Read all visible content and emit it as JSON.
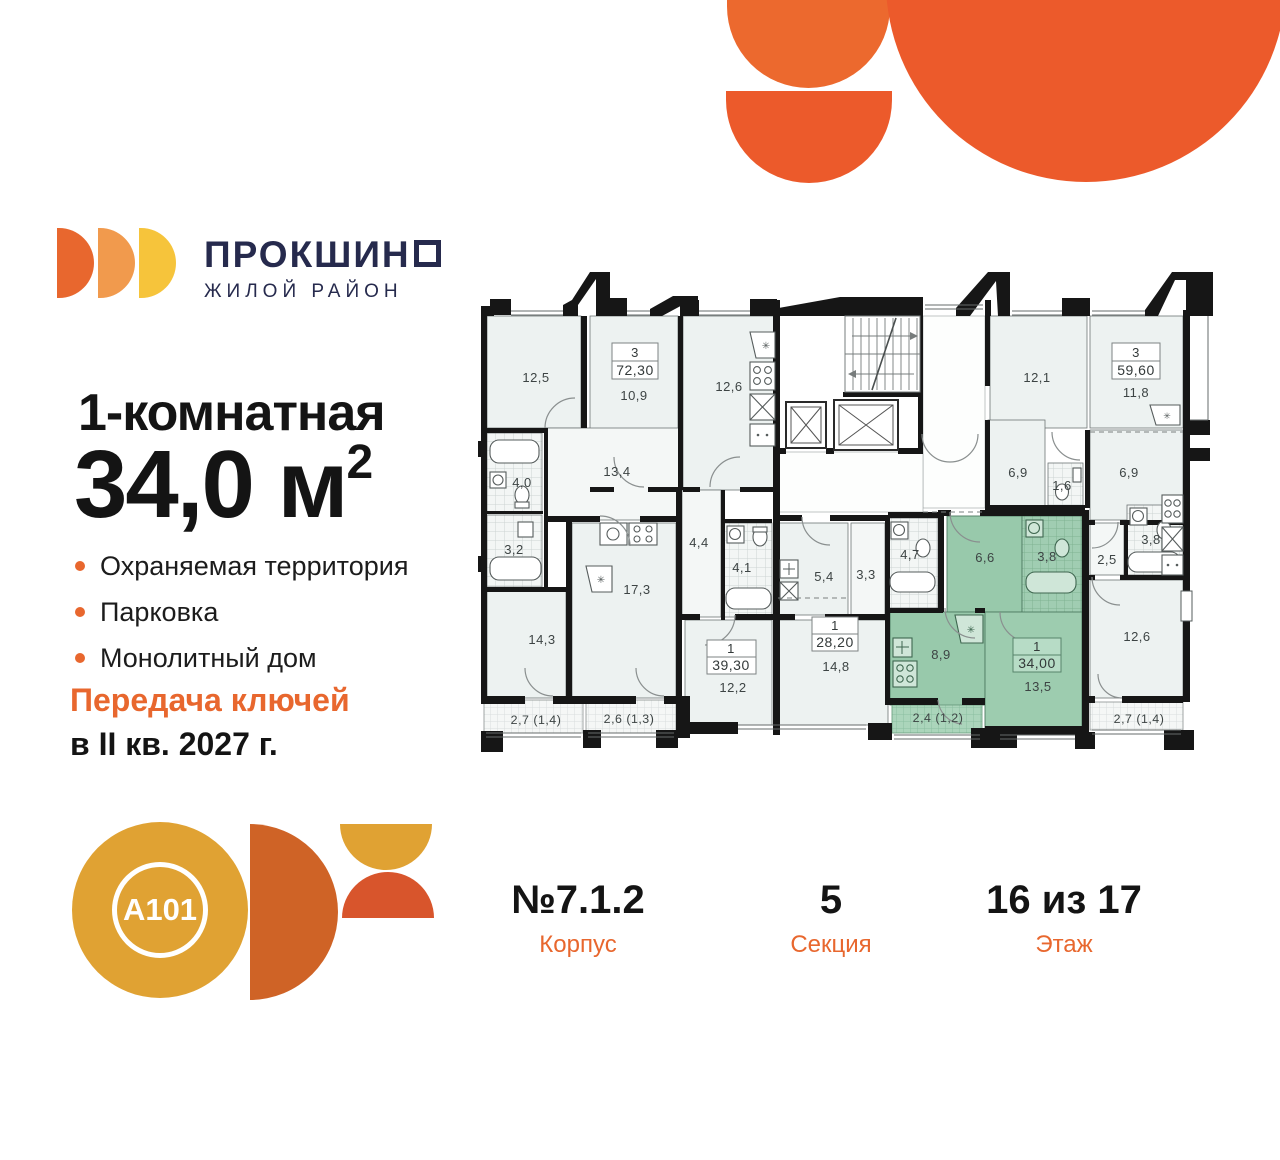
{
  "brand": {
    "name": "ПРОКШИНО",
    "name_display": "ПРОКШИН",
    "subtitle": "ЖИЛОЙ РАЙОН",
    "developer_logo": "A101",
    "colors": {
      "navy": "#262a4d",
      "orange": "#e8672e",
      "light_orange": "#f19a4d",
      "yellow": "#f6c43b",
      "gold": "#e0a233",
      "dark_orange": "#cf6326",
      "red_orange": "#d8552c",
      "decor": "#ec5a2b"
    }
  },
  "listing": {
    "rooms_title": "1-комнатная",
    "area_value": "34,0 м",
    "area_sup": "2",
    "features": [
      "Охраняемая территория",
      "Парковка",
      "Монолитный дом"
    ],
    "handover_label": "Передача ключей",
    "handover_date": "в II кв. 2027 г."
  },
  "details": {
    "items": [
      {
        "value": "№7.1.2",
        "label": "Корпус"
      },
      {
        "value": "5",
        "label": "Секция"
      },
      {
        "value": "16 из 17",
        "label": "Этаж"
      }
    ]
  },
  "floor_plan": {
    "highlight_color": "#98c9ab",
    "units": [
      {
        "rooms": "3",
        "area": "72,30",
        "highlighted": false
      },
      {
        "rooms": "1",
        "area": "39,30",
        "highlighted": false
      },
      {
        "rooms": "1",
        "area": "28,20",
        "highlighted": false
      },
      {
        "rooms": "1",
        "area": "34,00",
        "highlighted": true
      },
      {
        "rooms": "3",
        "area": "59,60",
        "highlighted": false
      }
    ],
    "room_labels": [
      "12,5",
      "10,9",
      "12,6",
      "13,4",
      "4,0",
      "3,2",
      "14,3",
      "2,7 (1,4)",
      "17,3",
      "4,4",
      "4,1",
      "12,2",
      "2,6 (1,3)",
      "5,4",
      "3,3",
      "4,7",
      "14,8",
      "6,6",
      "3,8",
      "8,9",
      "13,5",
      "2,4 (1,2)",
      "12,1",
      "11,8",
      "6,9",
      "1,6",
      "6,9",
      "2,5",
      "3,8",
      "12,6",
      "2,7 (1,4)"
    ]
  }
}
